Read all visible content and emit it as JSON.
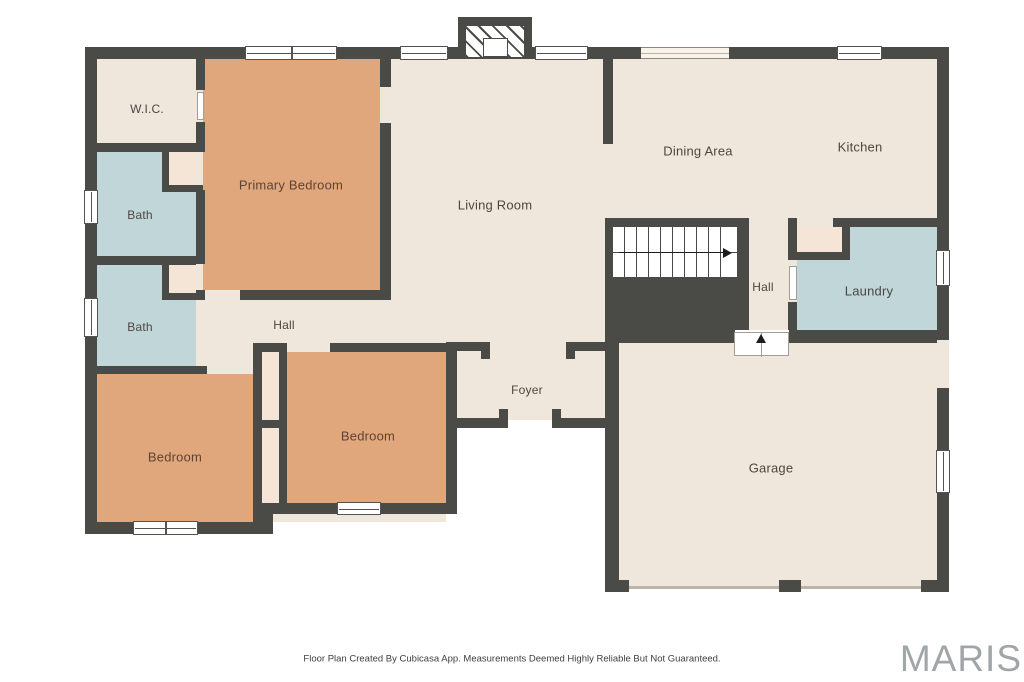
{
  "rooms": [
    {
      "name": "wic",
      "label": "W.I.C."
    },
    {
      "name": "primary-bedroom",
      "label": "Primary Bedroom"
    },
    {
      "name": "bath-upper",
      "label": "Bath"
    },
    {
      "name": "bath-lower",
      "label": "Bath"
    },
    {
      "name": "living-room",
      "label": "Living Room"
    },
    {
      "name": "dining-area",
      "label": "Dining Area"
    },
    {
      "name": "kitchen",
      "label": "Kitchen"
    },
    {
      "name": "hall-upper",
      "label": "Hall"
    },
    {
      "name": "laundry",
      "label": "Laundry"
    },
    {
      "name": "hall-bedroom-wing",
      "label": "Hall"
    },
    {
      "name": "foyer",
      "label": "Foyer"
    },
    {
      "name": "bedroom-left",
      "label": "Bedroom"
    },
    {
      "name": "bedroom-center",
      "label": "Bedroom"
    },
    {
      "name": "garage",
      "label": "Garage"
    }
  ],
  "footer": {
    "disclaimer": "Floor Plan Created By Cubicasa App. Measurements Deemed Highly Reliable But Not Guaranteed.",
    "brand": "MARIS"
  },
  "colors": {
    "wall": "#4a4a47",
    "floor": "#f0e7dc",
    "bedroom_fill": "#e1a77c",
    "bath_fill": "#c1d6d9",
    "closet_fill": "#f4e5d6",
    "window_fill": "#ffffff",
    "brand_gray": "#a0a5a8"
  }
}
